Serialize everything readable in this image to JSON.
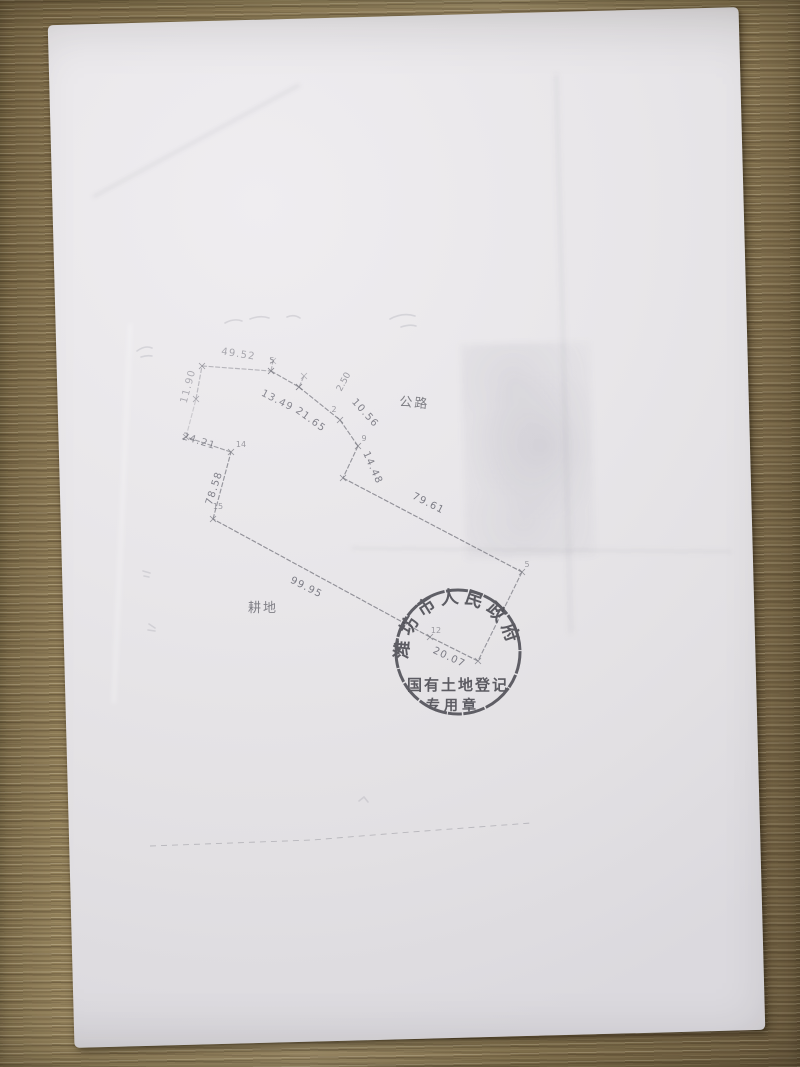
{
  "sketch": {
    "ink_color": "#82828a",
    "label_color": "#70707a",
    "area_labels": [
      {
        "text": "公路",
        "x": 414,
        "y": 407,
        "rot": 5
      },
      {
        "text": "耕地",
        "x": 263,
        "y": 612,
        "rot": 0
      }
    ],
    "segments": [
      {
        "x1": 202,
        "y1": 366,
        "x2": 271,
        "y2": 371,
        "label": "49.52",
        "lx": 238,
        "ly": 357,
        "lrot": 9,
        "op": 0.5
      },
      {
        "x1": 271,
        "y1": 371,
        "x2": 299,
        "y2": 387,
        "label": "13.49",
        "lx": 276,
        "ly": 403,
        "lrot": 27,
        "op": 0.75
      },
      {
        "x1": 299,
        "y1": 387,
        "x2": 340,
        "y2": 420,
        "label": "21.65",
        "lx": 309,
        "ly": 422,
        "lrot": 36,
        "op": 0.8
      },
      {
        "x1": 340,
        "y1": 420,
        "x2": 358,
        "y2": 446,
        "label": "10.56",
        "lx": 363,
        "ly": 415,
        "lrot": 48,
        "op": 0.8
      },
      {
        "x1": 358,
        "y1": 446,
        "x2": 343,
        "y2": 478,
        "label": "14.48",
        "lx": 370,
        "ly": 469,
        "lrot": 66,
        "op": 0.8
      },
      {
        "x1": 343,
        "y1": 478,
        "x2": 522,
        "y2": 572,
        "label": "79.61",
        "lx": 427,
        "ly": 506,
        "lrot": 27,
        "op": 0.85
      },
      {
        "x1": 522,
        "y1": 572,
        "x2": 478,
        "y2": 661,
        "label": "",
        "lx": 0,
        "ly": 0,
        "lrot": 0,
        "op": 0.78
      },
      {
        "x1": 478,
        "y1": 661,
        "x2": 430,
        "y2": 637,
        "label": "20.07",
        "lx": 448,
        "ly": 660,
        "lrot": 25,
        "op": 0.85
      },
      {
        "x1": 430,
        "y1": 637,
        "x2": 213,
        "y2": 519,
        "label": "99.95",
        "lx": 305,
        "ly": 590,
        "lrot": 27,
        "op": 0.85
      },
      {
        "x1": 213,
        "y1": 519,
        "x2": 231,
        "y2": 452,
        "label": "78.58",
        "lx": 217,
        "ly": 489,
        "lrot": -72,
        "op": 0.8
      },
      {
        "x1": 231,
        "y1": 452,
        "x2": 186,
        "y2": 437,
        "label": "24.21",
        "lx": 198,
        "ly": 444,
        "lrot": 17,
        "op": 0.7
      },
      {
        "x1": 186,
        "y1": 437,
        "x2": 196,
        "y2": 399,
        "label": "",
        "lx": 0,
        "ly": 0,
        "lrot": 0,
        "op": 0.3
      },
      {
        "x1": 196,
        "y1": 399,
        "x2": 202,
        "y2": 366,
        "label": "11.90",
        "lx": 191,
        "ly": 387,
        "lrot": -75,
        "op": 0.45
      },
      {
        "x1": 299,
        "y1": 387,
        "x2": 304,
        "y2": 376,
        "label": "",
        "lx": 0,
        "ly": 0,
        "lrot": 0,
        "op": 0.55
      },
      {
        "x1": 271,
        "y1": 371,
        "x2": 273,
        "y2": 361,
        "label": "",
        "lx": 0,
        "ly": 0,
        "lrot": 0,
        "op": 0.5
      }
    ],
    "point_labels": [
      {
        "text": "2.50",
        "x": 346,
        "y": 383,
        "rot": -62,
        "size": 9
      },
      {
        "text": "5",
        "x": 272,
        "y": 363,
        "rot": 0,
        "size": 8
      },
      {
        "text": "2",
        "x": 334,
        "y": 412,
        "rot": 0,
        "size": 8
      },
      {
        "text": "9",
        "x": 364,
        "y": 441,
        "rot": 0,
        "size": 8
      },
      {
        "text": "5",
        "x": 527,
        "y": 567,
        "rot": 0,
        "size": 8
      },
      {
        "text": "12",
        "x": 436,
        "y": 633,
        "rot": 0,
        "size": 8
      },
      {
        "text": "14",
        "x": 241,
        "y": 447,
        "rot": 0,
        "size": 8
      },
      {
        "text": "15",
        "x": 218,
        "y": 509,
        "rot": 0,
        "size": 8
      }
    ],
    "faint_marks": [
      "M225,323 q9,-5 17,-2",
      "M250,319 q10,-4 19,-1",
      "M287,317 q7,-3 13,1",
      "M390,319 q13,-7 25,-3",
      "M401,327 q9,-3 15,-1",
      "M137,351 q8,-6 15,-3",
      "M141,357 q6,-2 11,-1",
      "M143,571 l7,2",
      "M144,576 l5,1",
      "M149,624 l6,4",
      "M148,630 l7,1",
      "M359,801 l5,-4 l4,5"
    ],
    "dashed_boundary": [
      [
        150,
        846
      ],
      [
        312,
        840
      ],
      [
        398,
        833
      ],
      [
        531,
        823
      ]
    ]
  },
  "stamp": {
    "arc_text": "潍坊市人民政府",
    "row1": "国有土地登记",
    "row2": "专用章",
    "color": "#3e3e46"
  }
}
